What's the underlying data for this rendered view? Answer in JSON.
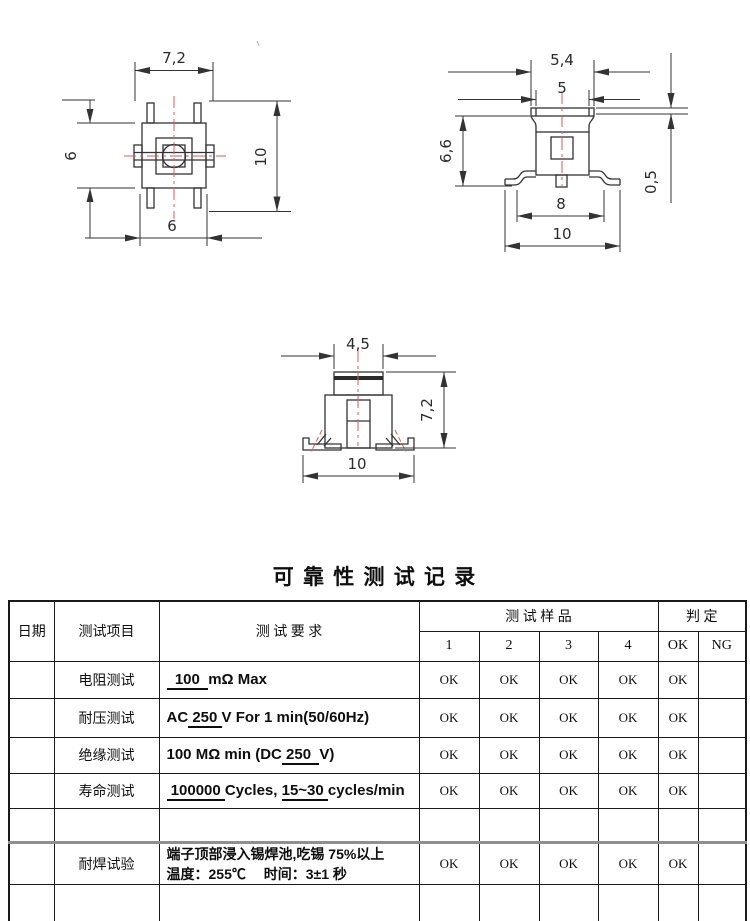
{
  "title": "可 靠 性 测 试 记 录",
  "drawings": {
    "top_view": {
      "width_top": "7,2",
      "height_left": "6",
      "height_right": "10",
      "width_bottom": "6"
    },
    "side_view": {
      "width_flange": "5,4",
      "width_stem": "5",
      "height_left": "6,6",
      "thickness_right": "0,5",
      "width_pins": "8",
      "width_base": "10"
    },
    "front_view": {
      "width_stem": "4,5",
      "height_right": "7,2",
      "width_base": "10"
    }
  },
  "table": {
    "col_date": "日期",
    "col_item": "测试项目",
    "col_requirement": "测 试 要 求",
    "col_samples": "测 试 样 品",
    "col_judgement": "判 定",
    "sample_numbers": [
      "1",
      "2",
      "3",
      "4"
    ],
    "judge_labels": [
      "OK",
      "NG"
    ],
    "rows": [
      {
        "item": "电阻测试",
        "req_lines": [
          [
            {
              "t": "  100  ",
              "u": true
            },
            {
              "t": "mΩ Max",
              "u": false
            }
          ]
        ],
        "samples": [
          "OK",
          "OK",
          "OK",
          "OK"
        ],
        "ok": "OK",
        "ng": ""
      },
      {
        "item": "耐压测试",
        "req_lines": [
          [
            {
              "t": "AC",
              "u": false
            },
            {
              "t": " 250 ",
              "u": true
            },
            {
              "t": "V For 1 min(50/60Hz)",
              "u": false
            }
          ]
        ],
        "samples": [
          "OK",
          "OK",
          "OK",
          "OK"
        ],
        "ok": "OK",
        "ng": ""
      },
      {
        "item": "绝缘测试",
        "req_lines": [
          [
            {
              "t": "100 MΩ min (DC",
              "u": false
            },
            {
              "t": " 250  ",
              "u": true
            },
            {
              "t": "V)",
              "u": false
            }
          ]
        ],
        "samples": [
          "OK",
          "OK",
          "OK",
          "OK"
        ],
        "ok": "OK",
        "ng": ""
      },
      {
        "item": "寿命测试",
        "req_lines": [
          [
            {
              "t": " 100000 ",
              "u": true
            },
            {
              "t": "Cycles, ",
              "u": false
            },
            {
              "t": "15~30 ",
              "u": true
            },
            {
              "t": "cycles/min",
              "u": false
            }
          ]
        ],
        "samples": [
          "OK",
          "OK",
          "OK",
          "OK"
        ],
        "ok": "OK",
        "ng": ""
      },
      {
        "item": "",
        "req_lines": [],
        "samples": [
          "",
          "",
          "",
          ""
        ],
        "ok": "",
        "ng": ""
      },
      {
        "item": "耐焊试验",
        "cn": true,
        "thick_top": true,
        "req_lines": [
          [
            {
              "t": "端子顶部浸入锡焊池,吃锡 75%以上",
              "u": false
            }
          ],
          [
            {
              "t": "温度：255℃　 时间：3±1 秒",
              "u": false
            }
          ]
        ],
        "samples": [
          "OK",
          "OK",
          "OK",
          "OK"
        ],
        "ok": "OK",
        "ng": ""
      },
      {
        "item": "",
        "req_lines": [],
        "samples": [
          "",
          "",
          "",
          ""
        ],
        "ok": "",
        "ng": ""
      }
    ]
  }
}
